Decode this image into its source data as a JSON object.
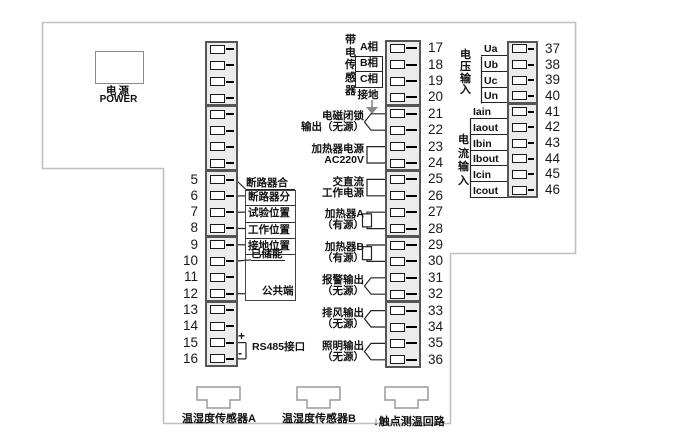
{
  "diagram": {
    "power": {
      "label_cn": "电源",
      "label_en": "POWER"
    },
    "left_strip": {
      "numbers": [
        "5",
        "6",
        "7",
        "8",
        "9",
        "10",
        "11",
        "12",
        "13",
        "14",
        "15",
        "16"
      ],
      "labels": {
        "breaker_close": "断路器合",
        "breaker_open": "断路器分",
        "test_position": "试验位置",
        "work_position": "工作位置",
        "ground_position": "接地位置",
        "energy_stored": "已储能",
        "common_terminal": "公共端",
        "plus": "+",
        "minus": "-",
        "rs485": "RS485接口"
      }
    },
    "middle_strip": {
      "numbers": [
        "17",
        "18",
        "19",
        "20",
        "21",
        "22",
        "23",
        "24",
        "25",
        "26",
        "27",
        "28",
        "29",
        "30",
        "31",
        "32",
        "33",
        "34",
        "35",
        "36"
      ],
      "live_sensor_group": "带电传感器",
      "phases": [
        "A相",
        "B相",
        "C相"
      ],
      "ground": "接地",
      "function_labels": [
        {
          "line1": "电磁闭锁",
          "line2": "输出（无源）",
          "terminals": [
            21,
            22
          ],
          "bracket": "brace"
        },
        {
          "line1": "加热器电源",
          "line2": "AC220V",
          "terminals": [
            23,
            24
          ],
          "bracket": "square"
        },
        {
          "line1": "交直流",
          "line2": "工作电源",
          "terminals": [
            25,
            26
          ],
          "bracket": "square"
        },
        {
          "line1": "加热器A",
          "line2": "（有源）",
          "terminals": [
            27,
            28
          ],
          "bracket": "resistor"
        },
        {
          "line1": "加热器B",
          "line2": "（有源）",
          "terminals": [
            29,
            30
          ],
          "bracket": "resistor"
        },
        {
          "line1": "报警输出",
          "line2": "（无源）",
          "terminals": [
            31,
            32
          ],
          "bracket": "brace"
        },
        {
          "line1": "排风输出",
          "line2": "（无源）",
          "terminals": [
            33,
            34
          ],
          "bracket": "brace"
        },
        {
          "line1": "照明输出",
          "line2": "（无源）",
          "terminals": [
            35,
            36
          ],
          "bracket": "brace"
        }
      ]
    },
    "right_strip": {
      "numbers": [
        "37",
        "38",
        "39",
        "40",
        "41",
        "42",
        "43",
        "44",
        "45",
        "46"
      ],
      "voltage_group": "电压输入",
      "voltage_labels": [
        "Ua",
        "Ub",
        "Uc",
        "Un"
      ],
      "current_group": "电流输入",
      "current_labels": [
        "Iain",
        "Iaout",
        "Ibin",
        "Ibout",
        "Icin",
        "Icout"
      ]
    },
    "connectors": [
      {
        "label": "温湿度传感器A"
      },
      {
        "label": "温湿度传感器B"
      },
      {
        "label": "↓触点测温回路"
      }
    ]
  }
}
